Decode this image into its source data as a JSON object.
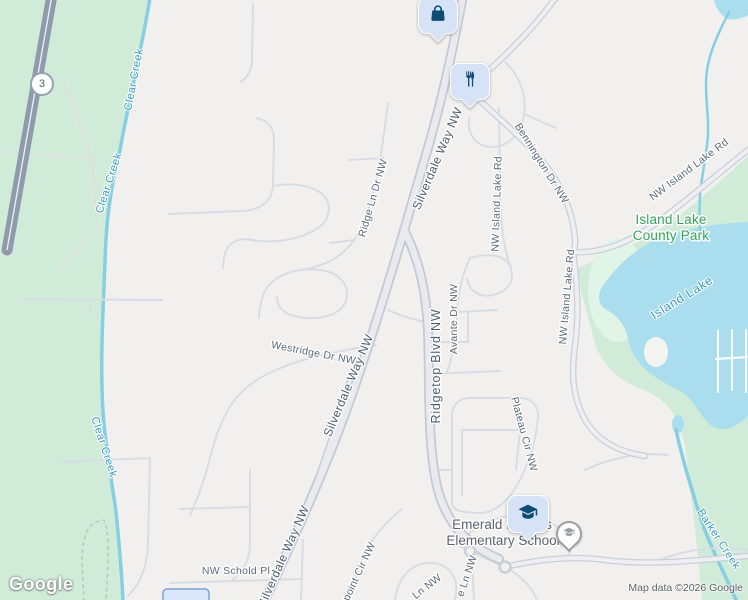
{
  "map": {
    "attribution": "Map data ©2026 Google",
    "logo": "Google",
    "highway_shield": "3",
    "labels": {
      "clear_creek": "Clear Creek",
      "barker_creek": "Barker Creek",
      "island_lake": "Island Lake",
      "park_line1": "Island Lake",
      "park_line2": "County Park",
      "silverdale_way": "Silverdale Way NW",
      "ridge_ln": "Ridge Ln Dr NW",
      "westridge": "Westridge Dr NW",
      "ridgetop": "Ridgetop Blvd NW",
      "avante": "Avante Dr NW",
      "bennington": "Bennington Dr NW",
      "nw_island_lake_rd": "NW Island Lake Rd",
      "plateau": "Plateau Cir NW",
      "nw_schold": "NW Schold Pl",
      "ridgepoint": "Ridgepoint Cir NW",
      "ln_nw": "e Ln NW",
      "ln_nw2": "Ln NW",
      "school_line1": "Emerald Heights",
      "school_line2": "Elementary School"
    },
    "pois": [
      {
        "id": "shopping",
        "icon": "shopping-bag-icon"
      },
      {
        "id": "restaurant",
        "icon": "restaurant-icon"
      },
      {
        "id": "school",
        "icon": "graduation-cap-icon"
      },
      {
        "id": "school_secondary",
        "icon": "graduation-cap-gray-icon"
      }
    ],
    "colors": {
      "background": "#f1f0ee",
      "park": "#d0ecd9",
      "park_light": "#e1f4e8",
      "water": "#aadeee",
      "water_line": "#86cfe3",
      "road_minor": "#d8dde5",
      "road_fill": "#edeff2",
      "road_casing": "#c9cfd7",
      "arterial_fill": "#e8eaee",
      "arterial_casing": "#c3cad4",
      "freeway": "#8f9aab",
      "freeway_line": "#e9edf2",
      "label_road": "#5a6a7a",
      "label_major": "#4e5e6e",
      "label_water": "#3f9cbd",
      "label_park": "#36a45c",
      "label_poi": "#5c646d",
      "pin_bg": "#d6e3f7",
      "pin_glyph": "#0f4c74",
      "icon_gray": "#9aa0a6",
      "attribution": "#5f6368",
      "shield": "#97a2b0",
      "building_fill": "#dbe7fa",
      "building_stroke": "#7aa0d8",
      "trail": "#b7c9bd",
      "park_path": "#e3dbe3"
    }
  }
}
